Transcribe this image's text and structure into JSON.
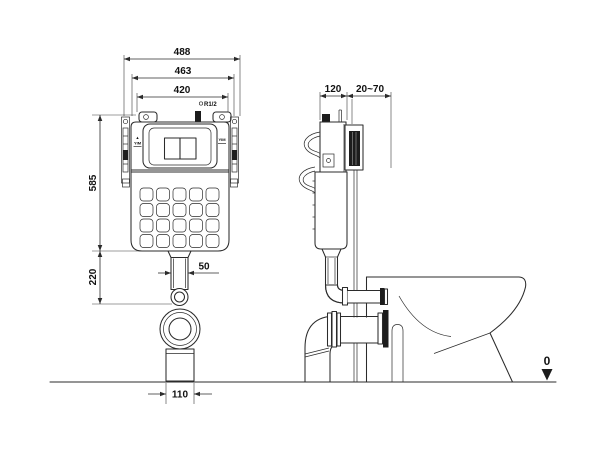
{
  "front_view": {
    "dim_488": "488",
    "dim_463": "463",
    "dim_420": "420",
    "dim_585": "585",
    "dim_220": "220",
    "dim_50": "50",
    "dim_110": "110",
    "inlet_label": "R1/2",
    "level_marker_symbol": "▲",
    "level_marker_left": "YIM",
    "level_marker_right": "YIM"
  },
  "side_view": {
    "dim_120": "120",
    "dim_20_70": "20~70"
  },
  "datum_label": "0",
  "colors": {
    "line": "#2b2b2b",
    "dark_fill": "#1c1c1c",
    "background": "#ffffff"
  }
}
